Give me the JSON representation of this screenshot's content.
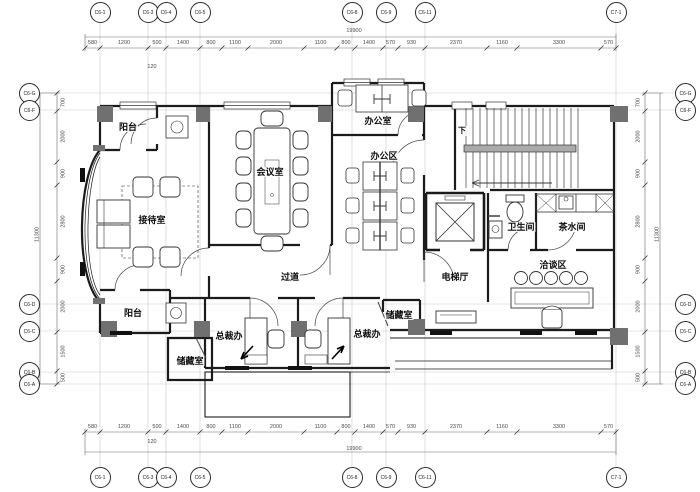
{
  "drawing": {
    "background": "#ffffff",
    "wall_color": "#1b1b1b",
    "dim_color": "#4a4a4a",
    "grid_line_color": "#c9c9c9",
    "column_fill": "#707070"
  },
  "grid": {
    "top": [
      {
        "id": "C6-1",
        "x": 100
      },
      {
        "id": "C6-3",
        "x": 148
      },
      {
        "id": "C6-4",
        "x": 166
      },
      {
        "id": "C6-5",
        "x": 200
      },
      {
        "id": "C6-8",
        "x": 352
      },
      {
        "id": "C6-9",
        "x": 386
      },
      {
        "id": "C6-11",
        "x": 425
      },
      {
        "id": "C7-1",
        "x": 616
      }
    ],
    "bottom": [
      {
        "id": "C6-1",
        "x": 100
      },
      {
        "id": "C6-3",
        "x": 148
      },
      {
        "id": "C6-4",
        "x": 166
      },
      {
        "id": "C6-5",
        "x": 200
      },
      {
        "id": "C6-8",
        "x": 352
      },
      {
        "id": "C6-9",
        "x": 386
      },
      {
        "id": "C6-11",
        "x": 425
      },
      {
        "id": "C7-1",
        "x": 616
      }
    ],
    "left": [
      {
        "id": "C6-G",
        "y": 93
      },
      {
        "id": "C6-F",
        "y": 110
      },
      {
        "id": "C6-D",
        "y": 304
      },
      {
        "id": "C6-C",
        "y": 331
      },
      {
        "id": "C6-B",
        "y": 372
      },
      {
        "id": "C6-A",
        "y": 384
      }
    ],
    "right": [
      {
        "id": "C6-G",
        "y": 93
      },
      {
        "id": "C6-F",
        "y": 110
      },
      {
        "id": "C6-D",
        "y": 304
      },
      {
        "id": "C6-C",
        "y": 331
      },
      {
        "id": "C6-B",
        "y": 372
      },
      {
        "id": "C6-A",
        "y": 384
      }
    ]
  },
  "dims": {
    "top": [
      "580",
      "1200",
      "500",
      "1400",
      "800",
      "1100",
      "2000",
      "1100",
      "800",
      "1400",
      "570",
      "930",
      "2370",
      "1160",
      "3300",
      "570"
    ],
    "bottom": [
      "580",
      "1200",
      "500",
      "1400",
      "800",
      "1100",
      "2000",
      "1100",
      "800",
      "1400",
      "570",
      "930",
      "2370",
      "1160",
      "3300",
      "570"
    ],
    "left": [
      "700",
      "2000",
      "900",
      "2800",
      "900",
      "2000",
      "1500",
      "500"
    ],
    "right": [
      "700",
      "2000",
      "900",
      "2800",
      "900",
      "2000",
      "1500",
      "500"
    ],
    "total_top": "19900",
    "total_bottom": "19900",
    "total_left": "11300",
    "total_right": "11300",
    "sub_top": "120",
    "sub_bottom": "120"
  },
  "rooms": [
    {
      "name": "balcony-top",
      "label": "阳台",
      "x": 128,
      "y": 127
    },
    {
      "name": "office",
      "label": "办公室",
      "x": 378,
      "y": 121
    },
    {
      "name": "office-area",
      "label": "办公区",
      "x": 384,
      "y": 156
    },
    {
      "name": "meeting-room",
      "label": "会议室",
      "x": 270,
      "y": 172
    },
    {
      "name": "reception",
      "label": "接待室",
      "x": 152,
      "y": 220
    },
    {
      "name": "stair-down",
      "label": "下",
      "x": 462,
      "y": 131,
      "small": true
    },
    {
      "name": "toilet",
      "label": "卫生间",
      "x": 521,
      "y": 227
    },
    {
      "name": "pantry",
      "label": "茶水间",
      "x": 572,
      "y": 227
    },
    {
      "name": "elevator-hall",
      "label": "电梯厅",
      "x": 455,
      "y": 277
    },
    {
      "name": "negotiation-area",
      "label": "洽谈区",
      "x": 553,
      "y": 265
    },
    {
      "name": "corridor",
      "label": "过道",
      "x": 290,
      "y": 277
    },
    {
      "name": "balcony-bottom",
      "label": "阳台",
      "x": 133,
      "y": 313
    },
    {
      "name": "ceo-office-left",
      "label": "总裁办",
      "x": 229,
      "y": 336
    },
    {
      "name": "ceo-office-right",
      "label": "总裁办",
      "x": 367,
      "y": 334
    },
    {
      "name": "storage-left",
      "label": "储藏室",
      "x": 190,
      "y": 361
    },
    {
      "name": "storage-right",
      "label": "储藏室",
      "x": 399,
      "y": 315
    }
  ]
}
